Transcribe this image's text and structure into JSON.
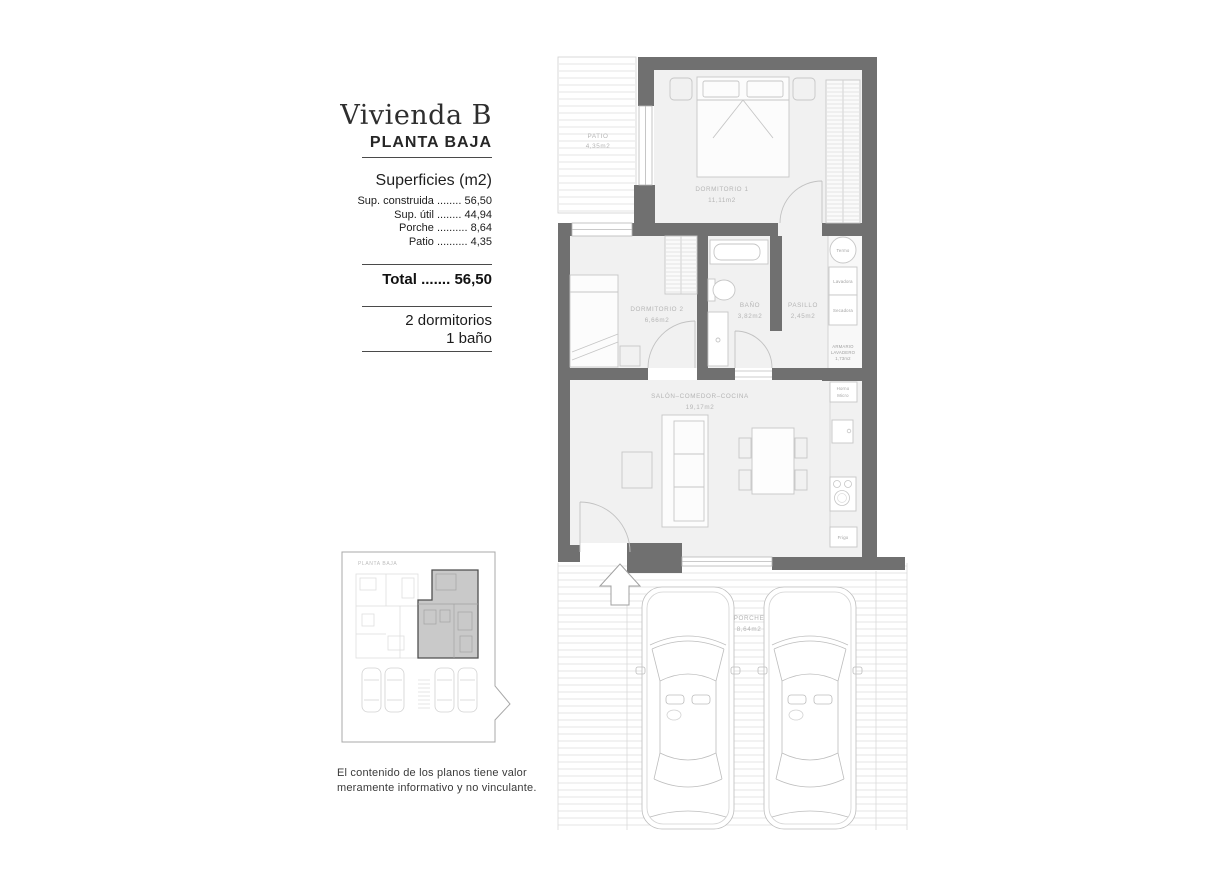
{
  "panel": {
    "title": "Vivienda B",
    "subtitle": "PLANTA BAJA",
    "surfaces_heading": "Superficies (m2)",
    "surfaces": [
      {
        "label": "Sup. construida",
        "dots": "........",
        "value": "56,50"
      },
      {
        "label": "Sup. útil",
        "dots": "........",
        "value": "44,94"
      },
      {
        "label": "Porche",
        "dots": "..........",
        "value": "8,64"
      },
      {
        "label": "Patio",
        "dots": "..........",
        "value": "4,35"
      }
    ],
    "total_label": "Total",
    "total_dots": ".......",
    "total_value": "56,50",
    "features_line1": "2 dormitorios",
    "features_line2": "1 baño",
    "keyplan_label": "PLANTA BAJA",
    "disclaimer_line1": "El contenido de los planos tiene valor",
    "disclaimer_line2": "meramente informativo y no vinculante."
  },
  "plan": {
    "rooms": {
      "patio": {
        "name": "PATIO",
        "area": "4,35m2"
      },
      "dormitorio1": {
        "name": "DORMITORIO 1",
        "area": "11,11m2"
      },
      "dormitorio2": {
        "name": "DORMITORIO 2",
        "area": "6,66m2"
      },
      "bano": {
        "name": "BAÑO",
        "area": "3,82m2"
      },
      "pasillo": {
        "name": "PASILLO",
        "area": "2,45m2"
      },
      "salon": {
        "name": "SALÓN–COMEDOR–COCINA",
        "area": "19,17m2"
      },
      "porche": {
        "name": "PORCHE",
        "area": "8,64m2"
      },
      "armario": {
        "line1": "ARMARIO",
        "line2": "LAVADERO",
        "line3": "1,73m2"
      }
    },
    "appliances": {
      "termo": "Termo",
      "lavadora": "Lavadora",
      "secadora": "Secadora",
      "horno_line1": "Horno",
      "horno_line2": "Micro",
      "frigo": "Frigo"
    }
  },
  "colors": {
    "wall": "#707070",
    "floor": "#f1f1f1",
    "furniture": "#c6c6c6",
    "hatch": "#e5e5e5",
    "room_label": "#b5b5b5",
    "keyplan_highlight": "#c9c9c9",
    "text": "#2d2d2d"
  }
}
